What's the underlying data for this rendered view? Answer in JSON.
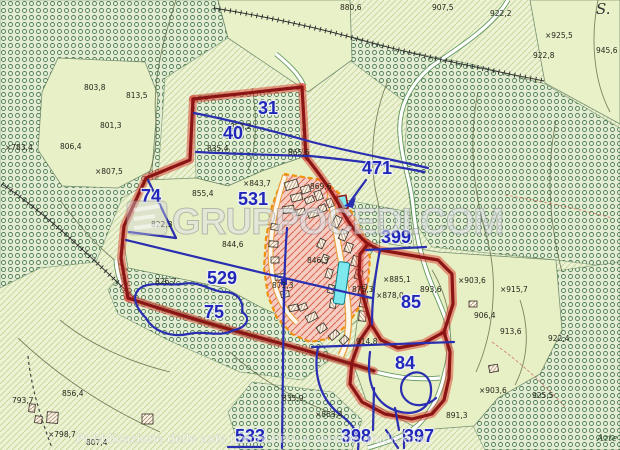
{
  "watermark": {
    "brand": "GRUPPOCEDI.COM",
    "logo": "cedi-stripes-logo",
    "bottom_text": "Pubblicazione delle aste immobiliari e vendite giudiziarie"
  },
  "map": {
    "parcel_labels": [
      {
        "name": "parcel-label-31",
        "x": 268,
        "y": 114,
        "text": "31"
      },
      {
        "name": "parcel-label-40",
        "x": 233,
        "y": 139,
        "text": "40"
      },
      {
        "name": "parcel-label-471",
        "x": 377,
        "y": 174,
        "text": "471"
      },
      {
        "name": "parcel-label-74",
        "x": 151,
        "y": 202,
        "text": "74"
      },
      {
        "name": "parcel-label-531",
        "x": 253,
        "y": 205,
        "text": "531"
      },
      {
        "name": "parcel-label-399",
        "x": 396,
        "y": 243,
        "text": "399"
      },
      {
        "name": "parcel-label-529",
        "x": 222,
        "y": 284,
        "text": "529"
      },
      {
        "name": "parcel-label-75",
        "x": 214,
        "y": 318,
        "text": "75"
      },
      {
        "name": "parcel-label-85",
        "x": 411,
        "y": 308,
        "text": "85"
      },
      {
        "name": "parcel-label-84",
        "x": 405,
        "y": 369,
        "text": "84"
      },
      {
        "name": "parcel-label-533",
        "x": 250,
        "y": 442,
        "text": "533"
      },
      {
        "name": "parcel-label-398",
        "x": 356,
        "y": 442,
        "text": "398"
      },
      {
        "name": "parcel-label-397",
        "x": 419,
        "y": 442,
        "text": "397"
      }
    ],
    "elevation_labels": [
      {
        "x": 5,
        "y": 150,
        "text": "×783,4"
      },
      {
        "x": 84,
        "y": 90,
        "text": "803,8"
      },
      {
        "x": 126,
        "y": 98,
        "text": "813,5"
      },
      {
        "x": 100,
        "y": 128,
        "text": "801,3"
      },
      {
        "x": 60,
        "y": 149,
        "text": "806,4"
      },
      {
        "x": 95,
        "y": 174,
        "text": "×807,5"
      },
      {
        "x": 340,
        "y": 10,
        "text": "880,6"
      },
      {
        "x": 432,
        "y": 10,
        "text": "907,5"
      },
      {
        "x": 490,
        "y": 16,
        "text": "922,2"
      },
      {
        "x": 545,
        "y": 38,
        "text": "×925,5"
      },
      {
        "x": 533,
        "y": 58,
        "text": "922,8"
      },
      {
        "x": 596,
        "y": 53,
        "text": "945,6"
      },
      {
        "x": 230,
        "y": 129,
        "text": "853,2"
      },
      {
        "x": 207,
        "y": 151,
        "text": "835,4"
      },
      {
        "x": 192,
        "y": 196,
        "text": "855,4"
      },
      {
        "x": 243,
        "y": 186,
        "text": "×843,7"
      },
      {
        "x": 151,
        "y": 227,
        "text": "822,3"
      },
      {
        "x": 222,
        "y": 247,
        "text": "844,6"
      },
      {
        "x": 155,
        "y": 284,
        "text": "826,7"
      },
      {
        "x": 288,
        "y": 155,
        "text": "865,6"
      },
      {
        "x": 310,
        "y": 189,
        "text": "869,6"
      },
      {
        "x": 307,
        "y": 263,
        "text": "846,3"
      },
      {
        "x": 352,
        "y": 292,
        "text": "875,3"
      },
      {
        "x": 272,
        "y": 288,
        "text": "873,3"
      },
      {
        "x": 383,
        "y": 282,
        "text": "×885,1"
      },
      {
        "x": 420,
        "y": 292,
        "text": "893,6"
      },
      {
        "x": 376,
        "y": 298,
        "text": "×878,0"
      },
      {
        "x": 458,
        "y": 283,
        "text": "×903,6"
      },
      {
        "x": 500,
        "y": 292,
        "text": "×915,7"
      },
      {
        "x": 474,
        "y": 318,
        "text": "906,4"
      },
      {
        "x": 500,
        "y": 334,
        "text": "913,6"
      },
      {
        "x": 548,
        "y": 341,
        "text": "922,4"
      },
      {
        "x": 356,
        "y": 344,
        "text": "914,8"
      },
      {
        "x": 479,
        "y": 393,
        "text": "×903,6"
      },
      {
        "x": 532,
        "y": 398,
        "text": "925,5"
      },
      {
        "x": 446,
        "y": 418,
        "text": "891,3"
      },
      {
        "x": 315,
        "y": 417,
        "text": "×863,4"
      },
      {
        "x": 12,
        "y": 403,
        "text": "793,7"
      },
      {
        "x": 48,
        "y": 437,
        "text": "×798,7"
      },
      {
        "x": 62,
        "y": 396,
        "text": "856,4"
      },
      {
        "x": 86,
        "y": 445,
        "text": "807,4"
      },
      {
        "x": 282,
        "y": 401,
        "text": "835,9"
      }
    ],
    "place_labels": [
      {
        "x": 596,
        "y": 14,
        "text": "S.",
        "cls": "script",
        "name": "place-label-s"
      },
      {
        "x": 597,
        "y": 441,
        "text": "Azte",
        "cls": "smallit",
        "name": "place-label-azte"
      }
    ]
  },
  "colors": {
    "parcel_number_blue": "#2127b8",
    "boundary_red": "#8b1515",
    "boundary_red_halo": "#d93a2b",
    "highlight_orange": "#f08c00",
    "water_cyan": "#7de8ee",
    "terrain_green": "#4c7d55",
    "urban_pink": "#f6cdc2"
  }
}
